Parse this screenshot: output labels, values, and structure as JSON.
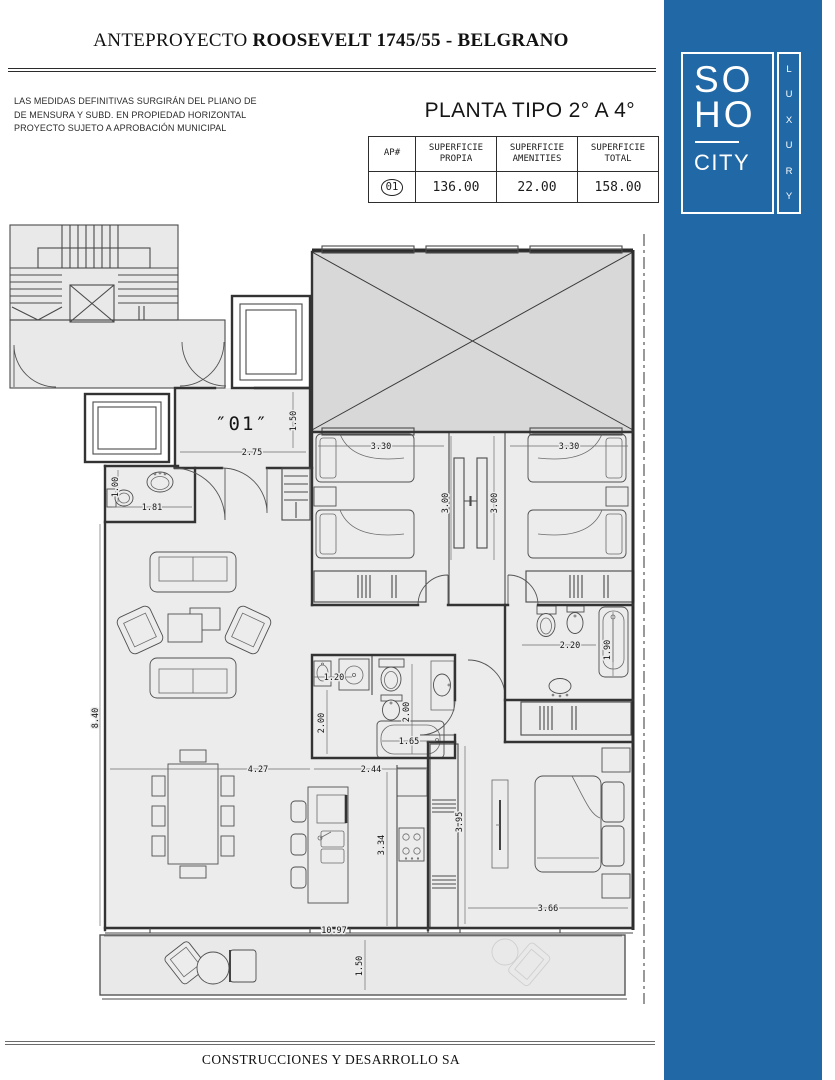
{
  "header": {
    "title_prefix": "ANTEPROYECTO ",
    "title_main": "ROOSEVELT 1745/55 - BELGRANO",
    "disclaimer": "LAS MEDIDAS DEFINITIVAS SURGIRÁN DEL PLIANO DE\nDE MENSURA Y SUBD. EN PROPIEDAD HORIZONTAL\nPROYECTO SUJETO A APROBACIÓN MUNICIPAL",
    "plan_title": "PLANTA TIPO 2° A 4°"
  },
  "table": {
    "headers": [
      "AP#",
      "SUPERFICIE\nPROPIA",
      "SUPERFICIE\nAMENITIES",
      "SUPERFICIE\nTOTAL"
    ],
    "row": {
      "ap": "01",
      "propia": "136.00",
      "amenities": "22.00",
      "total": "158.00"
    }
  },
  "plan": {
    "unit_label": "″01″",
    "dims": {
      "entry_width": "2.75",
      "entry_depth": "1.50",
      "bedroom2_width": "3.30",
      "bedroom3_width": "3.30",
      "bedroom2_depth": "3.00",
      "bedroom3_depth": "3.00",
      "toilette_depth": "1.00",
      "toilette_width": "1.81",
      "living_length": "8.40",
      "laundry_width": "1.20",
      "laundry_depth": "2.00",
      "bath_depth": "2.00",
      "bathtub_length": "1.65",
      "master_bath_width": "2.20",
      "master_bath_depth": "1.90",
      "dining_width": "4.27",
      "kitchen_width": "2.44",
      "kitchen_depth": "3.34",
      "master_bedroom_depth": "3.95",
      "master_bedroom_width": "3.66",
      "balcony_length": "10.97",
      "balcony_depth": "1.50"
    }
  },
  "logo": {
    "line1": "SO",
    "line2": "HO",
    "line3": "CITY",
    "vertical": "LUXURY"
  },
  "footer": {
    "company": "CONSTRUCCIONES Y DESARROLLO SA"
  },
  "colors": {
    "brand_blue": "#2168A6",
    "plan_fill": "#ECECEC",
    "patio_fill": "#D8D8D8"
  }
}
